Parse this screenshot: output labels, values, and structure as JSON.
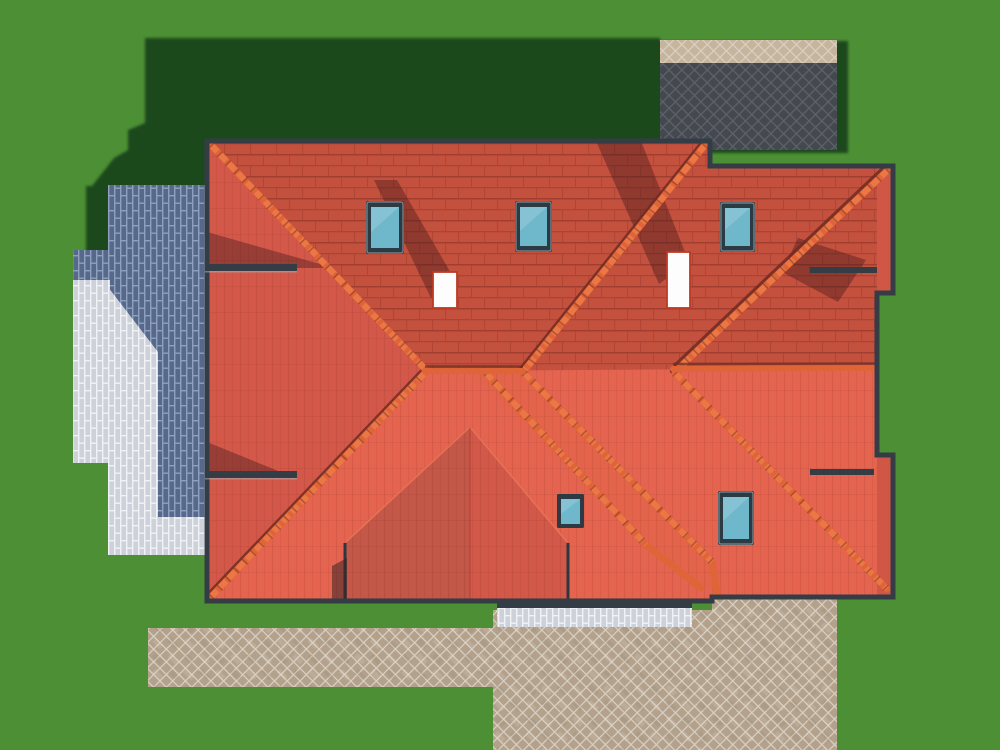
{
  "scene": {
    "description": "Aerial top-down 3D architectural rendering of a single-family house with a complex terracotta hip roof, surrounded by a green lawn, brick patios and a tan paver driveway",
    "view": "top-down orthographic",
    "lighting": {
      "sun_from": "south-east",
      "shadows_toward": "north-west"
    }
  },
  "house": {
    "roof_type": "multi-hip, terracotta tile",
    "skylights": {
      "count": 5,
      "glass": "teal",
      "frame": "dark slate"
    },
    "chimneys": {
      "count": 2,
      "color": "white",
      "trim": "red"
    },
    "ridge_tiles": "rounded orange caps along hips and ridges"
  },
  "ground": {
    "lawn": "sunlit green grass with large building shadow cast to the north-west",
    "paved_areas": [
      {
        "name": "left-patio",
        "material": "stacked brick pavers",
        "state": "partly in shadow (blue-gray), partly sunlit (white)"
      },
      {
        "name": "top-right-pavers",
        "material": "herringbone brick",
        "state": "shadowed dark gray with sunlit tan strip above"
      },
      {
        "name": "bottom-right-driveway",
        "material": "tan herringbone pavers",
        "state": "sunlit"
      },
      {
        "name": "bottom-walkway",
        "material": "tan herringbone pavers",
        "state": "sunlit"
      },
      {
        "name": "south-terrace-strip",
        "material": "white brick pavers",
        "state": "sunlit"
      }
    ]
  },
  "palette": {
    "grass_lit": "#4d8f35",
    "grass_shadow": "#1e4a1f",
    "roof_south": "#e56450",
    "roof_north": "#c4503e",
    "roof_west": "#d4584a",
    "roof_east": "#d05746",
    "wing_left": "#c35748",
    "wing_right": "#d2594a",
    "ridge": "#df6438",
    "ridge_highlight": "#ee7c49",
    "ridge_shadow": "#6e2c22",
    "eave": "#343c45",
    "glass": "#6fb7ca",
    "glass_highlight": "#9bd0de",
    "frame": "#2c3b43",
    "chimney": "#fdfdfd",
    "chimney_edge": "#bf3a22",
    "roof_shadow_band": "#451a1a",
    "pav_blue": "#57698a",
    "pav_blue_mortar": "#8ea0bd",
    "pav_white": "#cdd1da",
    "pav_white_mortar": "#f1f2f5",
    "pav_tan": "#b3a18b",
    "pav_tan_lit": "#c7b49d",
    "pav_tan_mortar": "#d8d1c5",
    "pav_gray": "#45494f",
    "pav_gray_mortar": "#5d636c"
  }
}
